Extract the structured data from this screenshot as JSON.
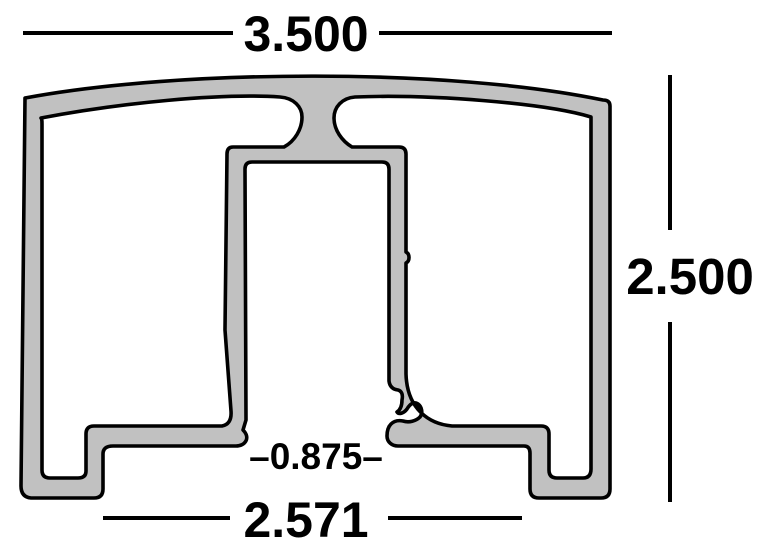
{
  "drawing": {
    "background_color": "#ffffff",
    "profile_fill_color": "#c1c1c1",
    "line_color": "#000000",
    "dimensions": {
      "top_width": "3.500",
      "overall_height": "2.500",
      "bottom_width": "2.571",
      "bottom_opening": "–0.875–"
    }
  }
}
